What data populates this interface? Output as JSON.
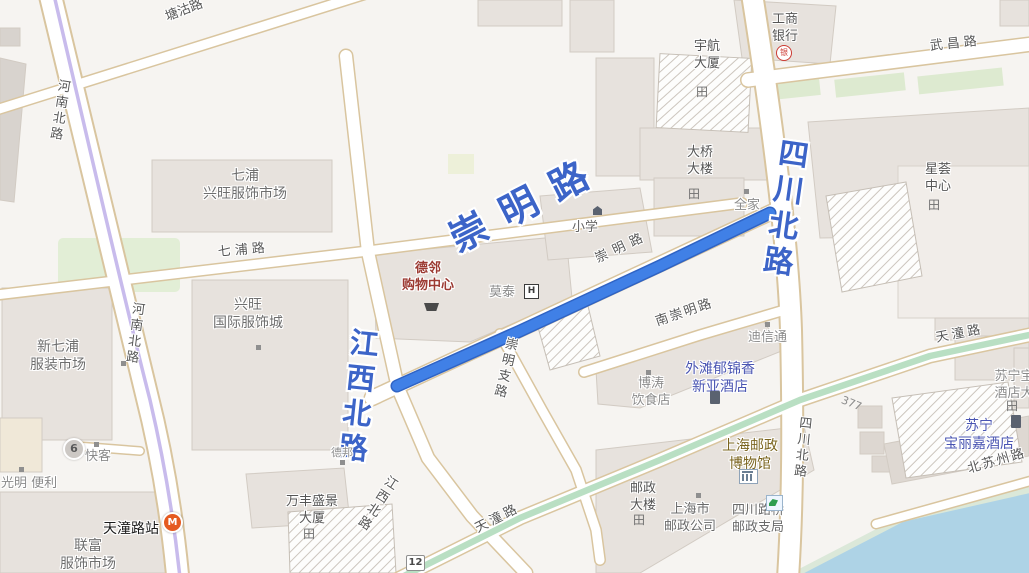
{
  "colors": {
    "route": "#4080E6",
    "route_casing": "#2F63C4",
    "big_road_label": "#3C64C8",
    "road_casing": "#D9C59F",
    "green_road": "#B9DFC3",
    "river": "#AED3E6",
    "metro_line": "#C8BBEC",
    "hotel_text": "#4A55B2",
    "mall_text": "#9C3A32",
    "museum_text": "#7A641E"
  },
  "icons": {
    "building": "田",
    "hotel_h": "H",
    "bank": "银",
    "metro": "M"
  },
  "roads": {
    "tanggu": "塘沽路",
    "henan": "河南北路",
    "qipu": "七浦路",
    "wuchang": "武昌路",
    "chongming": "崇明路",
    "chongming_branch": "崇明支路",
    "south_chongming": "南崇明路",
    "jiangxi": "江西北路",
    "sichuan": "四川北路",
    "tiantong": "天潼路",
    "beisuzhou": "北苏州路"
  },
  "badges": {
    "stop6": "6",
    "route12": "12",
    "lane377": "377"
  },
  "pois": {
    "qipu_market": {
      "l1": "七浦",
      "l2": "兴旺服饰市场"
    },
    "xingwang_city": {
      "l1": "兴旺",
      "l2": "国际服饰城"
    },
    "xinqipu_market": {
      "l1": "新七浦",
      "l2": "服装市场"
    },
    "lianfu_market": {
      "l1": "联富",
      "l2": "服饰市场"
    },
    "delin_mall": {
      "l1": "德邻",
      "l2": "购物中心"
    },
    "motai": {
      "l1": "莫泰"
    },
    "xiaoxue": {
      "l1": "小学"
    },
    "daqiao": {
      "l1": "大桥",
      "l2": "大楼"
    },
    "yuhang": {
      "l1": "宇航",
      "l2": "大厦"
    },
    "icbc": {
      "l1": "工商",
      "l2": "银行"
    },
    "xinghui": {
      "l1": "星荟",
      "l2": "中心"
    },
    "quanjia": {
      "l1": "全家"
    },
    "dixintong": {
      "l1": "迪信通"
    },
    "waitan_hotel": {
      "l1": "外滩郁锦香",
      "l2": "新亚酒店"
    },
    "botao": {
      "l1": "博涛",
      "l2": "饮食店"
    },
    "suning_hotel": {
      "l1": "苏宁",
      "l2": "宝丽嘉酒店"
    },
    "suning_edge": {
      "l1": "苏宁宝",
      "l2": "酒店大"
    },
    "post_museum": {
      "l1": "上海邮政",
      "l2": "博物馆"
    },
    "post_tower": {
      "l1": "邮政",
      "l2": "大楼"
    },
    "shanghai_post": {
      "l1": "上海市",
      "l2": "邮政公司"
    },
    "sichuanqiao_post": {
      "l1": "四川路桥",
      "l2": "邮政支局"
    },
    "wanfeng": {
      "l1": "万丰盛景",
      "l2": "大厦"
    },
    "guangming": {
      "l1": "光明 便利"
    },
    "kuaike": {
      "l1": "快客"
    },
    "debang": {
      "l1": "德邦"
    },
    "tiantong_station": {
      "l1": "天潼路站"
    }
  }
}
